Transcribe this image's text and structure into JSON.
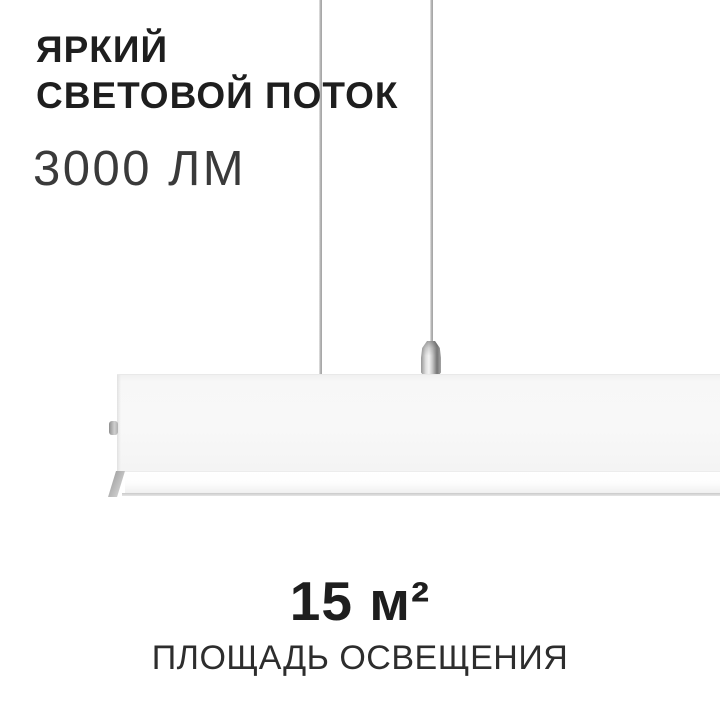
{
  "card": {
    "headline_line1": "ЯРКИЙ",
    "headline_line2": "СВЕТОВОЙ ПОТОК",
    "luminous_flux": "3000 ЛМ",
    "coverage_value": "15 м²",
    "coverage_label": "ПЛОЩАДЬ ОСВЕЩЕНИЯ",
    "colors": {
      "background": "#ffffff",
      "headline_text": "#1e1e1e",
      "secondary_text": "#3a3a3a",
      "lamp_body": "#f7f7f7",
      "diffuser": "#fdfdfd",
      "cable_metal": "#b5b5b5",
      "gripper_chrome": "#c4c4c4"
    }
  }
}
